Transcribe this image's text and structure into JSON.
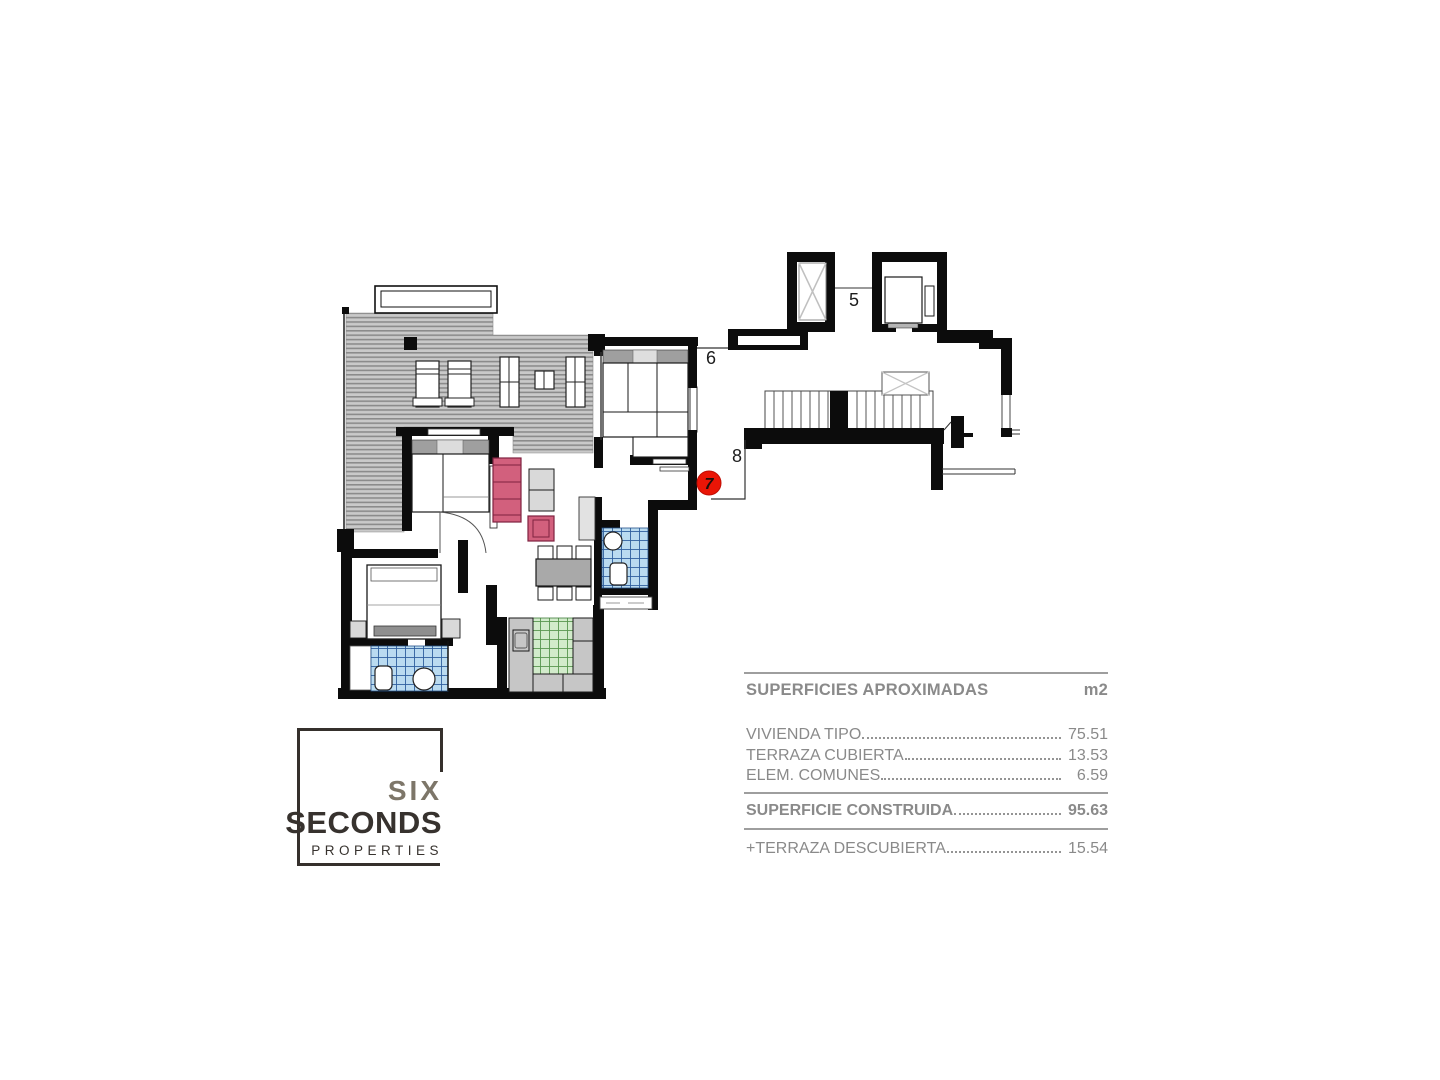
{
  "plan": {
    "labels": {
      "five": "5",
      "six": "6",
      "eight": "8"
    },
    "unit_badge": "7"
  },
  "areas_table": {
    "title": "SUPERFICIES APROXIMADAS",
    "unit_header": "m2",
    "rows": [
      {
        "label": "VIVIENDA TIPO",
        "value": "75.51"
      },
      {
        "label": "TERRAZA CUBIERTA",
        "value": "13.53"
      },
      {
        "label": "ELEM. COMUNES",
        "value": "6.59"
      }
    ],
    "total_row": {
      "label": "SUPERFICIE CONSTRUIDA",
      "value": "95.63"
    },
    "extra_row": {
      "label": "+TERRAZA DESCUBIERTA",
      "value": "15.54"
    }
  },
  "logo": {
    "word1": "SIX",
    "word2": "SECONDS",
    "word3": "PROPERTIES"
  },
  "colors": {
    "wall_black": "#0c0c0c",
    "badge_red": "#ea1506",
    "sofa_pink": "#d2607d",
    "tile_blue": "#badbf0",
    "tile_blue_grid": "#2f5f9e",
    "tile_green": "#d2ebcb",
    "tile_green_grid": "#58964f",
    "terrace_gray": "#c9c9c9",
    "table_text_gray": "#8a8a8a",
    "logo_dark": "#37322e",
    "logo_gray": "#7d7669"
  }
}
